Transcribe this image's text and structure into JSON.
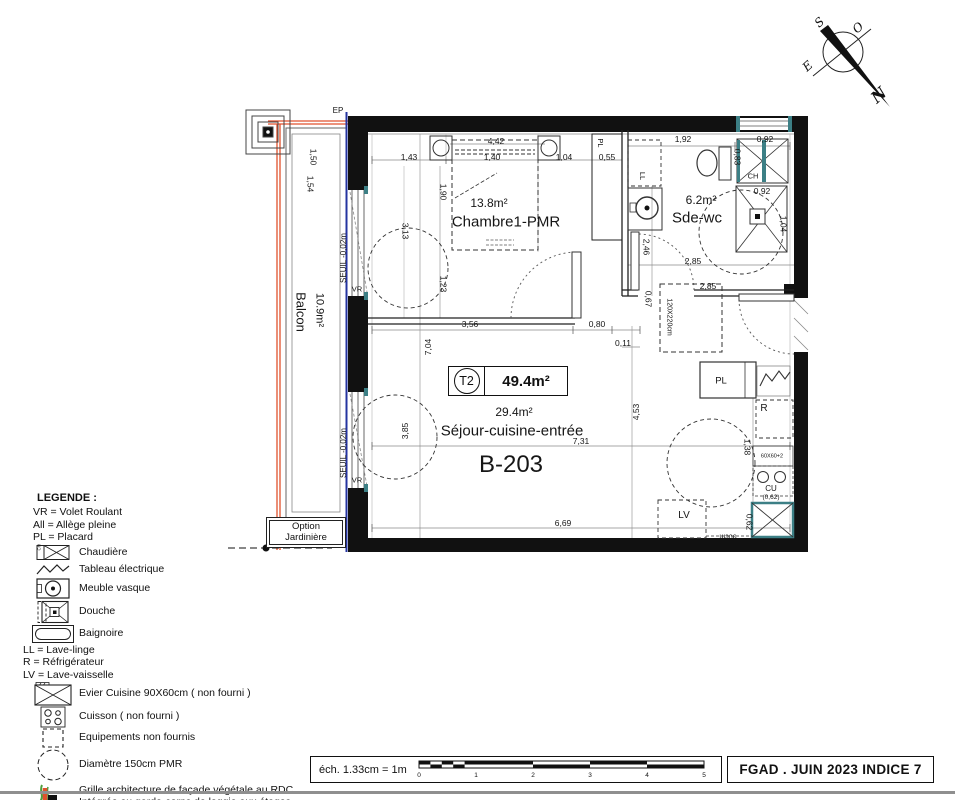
{
  "colors": {
    "wall": "#111111",
    "accent_orange": "#e0512d",
    "accent_blue": "#2534a0",
    "accent_teal": "#3c7f85",
    "legend_green": "#4f9e3c"
  },
  "north": {
    "n": "N",
    "s": "S",
    "e": "E",
    "o": "O"
  },
  "unit_box": {
    "type": "T2",
    "area": "49.4m²"
  },
  "rooms": {
    "chambre": {
      "area": "13.8m²",
      "name": "Chambre1-PMR"
    },
    "sde": {
      "area": "6.2m²",
      "name": "Sde-wc"
    },
    "sejour": {
      "area": "29.4m²",
      "name": "Séjour-cuisine-entrée"
    },
    "unit_number": "B-203"
  },
  "option_box": {
    "line1": "Option",
    "line2": "Jardinière"
  },
  "plan_texts": [
    {
      "t": "1,43",
      "x": 409,
      "y": 157
    },
    {
      "t": "1,40",
      "x": 492,
      "y": 157
    },
    {
      "t": "1,04",
      "x": 564,
      "y": 157
    },
    {
      "t": "0,55",
      "x": 607,
      "y": 157
    },
    {
      "t": "4,42",
      "x": 496,
      "y": 141
    },
    {
      "t": "1,92",
      "x": 683,
      "y": 139
    },
    {
      "t": "0,92",
      "x": 765,
      "y": 139
    },
    {
      "t": "0,92",
      "x": 762,
      "y": 191
    },
    {
      "t": "2,85",
      "x": 693,
      "y": 261
    },
    {
      "t": "2,85",
      "x": 708,
      "y": 286
    },
    {
      "t": "3,56",
      "x": 470,
      "y": 324
    },
    {
      "t": "0,80",
      "x": 597,
      "y": 324
    },
    {
      "t": "0,11",
      "x": 623,
      "y": 343
    },
    {
      "t": "7,31",
      "x": 581,
      "y": 441
    },
    {
      "t": "6,69",
      "x": 563,
      "y": 523
    },
    {
      "t": "0,83",
      "x": 737,
      "y": 157,
      "r": 90
    },
    {
      "t": "1,04",
      "x": 783,
      "y": 224,
      "r": 90
    },
    {
      "t": "2,46",
      "x": 646,
      "y": 247,
      "r": 90
    },
    {
      "t": "0,67",
      "x": 648,
      "y": 299,
      "r": 90
    },
    {
      "t": "1,90",
      "x": 443,
      "y": 192,
      "r": 90
    },
    {
      "t": "3,13",
      "x": 405,
      "y": 231,
      "r": 90
    },
    {
      "t": "1,23",
      "x": 443,
      "y": 284,
      "r": 90
    },
    {
      "t": "1,38",
      "x": 747,
      "y": 447,
      "r": 90
    },
    {
      "t": "0,62",
      "x": 749,
      "y": 522,
      "r": 90
    },
    {
      "t": "1,50",
      "x": 313,
      "y": 157,
      "r": 90
    },
    {
      "t": "1,54",
      "x": 310,
      "y": 184,
      "r": 90
    },
    {
      "t": "7,04",
      "x": 428,
      "y": 347,
      "r": -90
    },
    {
      "t": "3,85",
      "x": 405,
      "y": 431,
      "r": -90
    },
    {
      "t": "4,53",
      "x": 636,
      "y": 412,
      "r": -90
    },
    {
      "t": "120X220cm",
      "x": 669,
      "y": 317,
      "r": 90,
      "fs": 7
    },
    {
      "t": "EP",
      "x": 338,
      "y": 111,
      "fs": 8,
      "n": "ep-label"
    },
    {
      "t": "PL",
      "x": 600,
      "y": 143,
      "r": 90,
      "fs": 7.5,
      "n": "placard-chambre-label"
    },
    {
      "t": "LL",
      "x": 642,
      "y": 176,
      "r": 90,
      "fs": 7.5,
      "n": "lave-linge-label"
    },
    {
      "t": "CH",
      "x": 753,
      "y": 176,
      "fs": 7.5,
      "n": "chaudiere-label"
    },
    {
      "t": "PL",
      "x": 721,
      "y": 381,
      "fs": 9.5,
      "n": "placard-kitchen-label"
    },
    {
      "t": "R",
      "x": 764,
      "y": 409,
      "fs": 10,
      "n": "refrigerateur-label"
    },
    {
      "t": "60X60+2",
      "x": 772,
      "y": 457,
      "fs": 5.5,
      "n": "plan-note"
    },
    {
      "t": "CU",
      "x": 771,
      "y": 489,
      "fs": 8,
      "n": "cuisson-label"
    },
    {
      "t": "(0,62)",
      "x": 771,
      "y": 498,
      "fs": 6.5,
      "n": "plan-note"
    },
    {
      "t": "LV",
      "x": 684,
      "y": 516,
      "fs": 10,
      "n": "lave-vaisselle-label"
    },
    {
      "t": "90cm",
      "x": 728,
      "y": 536,
      "r": 180,
      "fs": 7,
      "n": "plan-note"
    },
    {
      "t": "VR",
      "x": 357,
      "y": 289,
      "fs": 7.5,
      "n": "volet-roulant-label"
    },
    {
      "t": "VR",
      "x": 357,
      "y": 480,
      "fs": 7.5,
      "n": "volet-roulant-label"
    },
    {
      "t": "SEUIL -0,02m",
      "x": 344,
      "y": 258,
      "r": -90,
      "fs": 8,
      "n": "seuil-label"
    },
    {
      "t": "SEUIL -0,02m",
      "x": 344,
      "y": 453,
      "r": -90,
      "fs": 8,
      "n": "seuil-label"
    },
    {
      "t": "10.9m²",
      "x": 319,
      "y": 310,
      "r": 90,
      "fs": 11,
      "n": "balcon-area"
    },
    {
      "t": "Balcon",
      "x": 301,
      "y": 312,
      "r": 90,
      "fs": 13,
      "n": "balcon-name"
    }
  ],
  "legend": {
    "title": "LEGENDE :",
    "abbrev1": [
      "VR = Volet Roulant",
      "All = Allège pleine",
      "PL = Placard"
    ],
    "items1": [
      "Chaudière",
      "Tableau électrique",
      "Meuble vasque",
      "Douche",
      "Baignoire"
    ],
    "abbrev2": [
      "LL = Lave-linge",
      "R = Réfrigérateur",
      "LV = Lave-vaisselle"
    ],
    "items2": [
      "Evier Cuisine 90X60cm ( non fourni )",
      "Cuisson ( non fourni )",
      "Equipements non fournis",
      "Diamètre 150cm PMR"
    ],
    "grille": [
      "Grille architecture de façade végétale au RDC",
      "Intégrée au garde-corps de loggia aux étages"
    ]
  },
  "scalebar": {
    "label": "éch. 1.33cm = 1m",
    "ticks": [
      "0",
      "1",
      "2",
      "3",
      "4",
      "5"
    ]
  },
  "titleblock": {
    "text": "FGAD . JUIN 2023 INDICE 7"
  }
}
